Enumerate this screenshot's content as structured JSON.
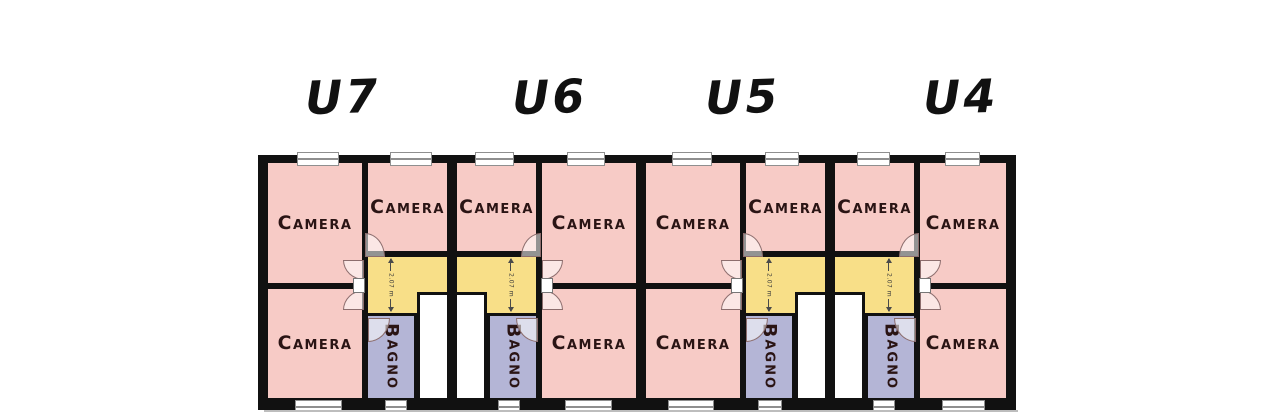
{
  "colors": {
    "camera": "#f7cbc6",
    "corridor": "#f8df88",
    "bagno": "#b4b5d6",
    "stairwell": "#ffffff",
    "wall": "#111111",
    "door": "#8c6d6d",
    "window_frame": "#8f8f8f",
    "label_text": "#2a1414",
    "unit_label": "#111111",
    "shadow": "#bdbdbd"
  },
  "units": [
    {
      "label": "U7",
      "cameras": [
        "Camera",
        "Camera",
        "Camera"
      ],
      "bagno": "Bagno",
      "corridor_dimension": "2.07 m"
    },
    {
      "label": "U6",
      "cameras": [
        "Camera",
        "Camera",
        "Camera"
      ],
      "bagno": "Bagno",
      "corridor_dimension": "2.07 m"
    },
    {
      "label": "U5",
      "cameras": [
        "Camera",
        "Camera",
        "Camera"
      ],
      "bagno": "Bagno",
      "corridor_dimension": "2.07 m"
    },
    {
      "label": "U4",
      "cameras": [
        "Camera",
        "Camera",
        "Camera"
      ],
      "bagno": "Bagno",
      "corridor_dimension": "2.07 m"
    }
  ]
}
